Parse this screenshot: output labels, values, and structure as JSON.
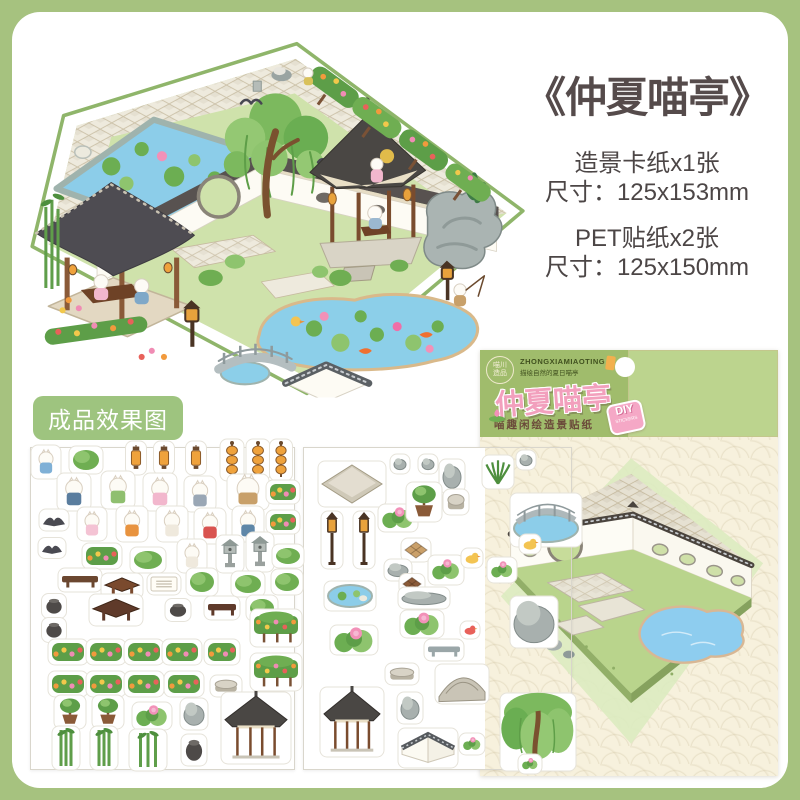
{
  "page": {
    "frame_color": "#a6c27f",
    "card_color": "#ffffff"
  },
  "product_info": {
    "title": "《仲夏喵亭》",
    "spec_lines": [
      "造景卡纸x1张",
      "尺寸：125x153mm",
      "PET贴纸x2张",
      "尺寸：125x150mm"
    ]
  },
  "effect_label": "成品效果图",
  "package": {
    "brand_stamp_line1": "喵川",
    "brand_stamp_line2": "造品",
    "brand_pinyin": "ZHONGXIAMIAOTING",
    "brand_tagline": "描绘自然的夏日喵亭",
    "title": "仲夏喵亭",
    "subtitle": "喵趣闲绘造景贴纸",
    "diy_badge": "DIY",
    "diy_badge_sub": "stickers",
    "header_color": "#a0bc6c",
    "body_color": "#f7f1dd",
    "title_pink": "#f2a0bd"
  },
  "colors": {
    "frame_green": "#a6c27f",
    "label_green": "#9ec47f",
    "text_dark": "#554b4b",
    "pond_blue": "#8ccde9",
    "grass_green": "#cfe2ab",
    "roof_dark": "#4e4c52",
    "stone_pale": "#eeeadd",
    "hedge_green": "#5d9e48",
    "lantern_orange": "#efa23c",
    "lotus_pink": "#f291b8",
    "wood_brown": "#7a4c2e"
  },
  "scene_icons": [
    "lotus-pond",
    "willow-tree",
    "hex-pavilion",
    "study-pavilion",
    "rockery",
    "koi-pond",
    "stone-bridge",
    "moon-gate",
    "flower-hedge",
    "cat-figures",
    "lamp-post",
    "bamboo"
  ],
  "sticker_sheets": {
    "sheet1_items": [
      [
        "cat",
        46,
        462,
        22,
        26,
        "#7fb0d6"
      ],
      [
        "bush",
        86,
        460,
        26,
        20
      ],
      [
        "lantern",
        136,
        458,
        13,
        26
      ],
      [
        "lantern",
        164,
        458,
        13,
        26
      ],
      [
        "lantern",
        196,
        458,
        13,
        26
      ],
      [
        "lanternstack",
        232,
        460,
        16,
        34
      ],
      [
        "lanternstack",
        258,
        460,
        16,
        34
      ],
      [
        "lanternstack",
        281,
        460,
        15,
        34
      ],
      [
        "cat",
        74,
        492,
        26,
        30,
        "#5a7d9e"
      ],
      [
        "cat",
        118,
        490,
        26,
        30,
        "#8fbf6f"
      ],
      [
        "cat",
        160,
        492,
        26,
        30,
        "#f2b7cd"
      ],
      [
        "cat",
        200,
        494,
        24,
        28,
        "#9aa7b5"
      ],
      [
        "cat",
        248,
        492,
        34,
        28,
        "#c8a06a"
      ],
      [
        "flowerbed",
        283,
        492,
        26,
        16
      ],
      [
        "bird",
        54,
        520,
        22,
        14
      ],
      [
        "bird",
        52,
        548,
        20,
        13
      ],
      [
        "cat",
        92,
        524,
        22,
        26,
        "#f4c3d4"
      ],
      [
        "cat",
        132,
        524,
        24,
        28,
        "#e8933f"
      ],
      [
        "cat",
        172,
        524,
        24,
        28,
        "#efe9dd"
      ],
      [
        "cat",
        210,
        526,
        24,
        28,
        "#d9534f"
      ],
      [
        "cat",
        248,
        524,
        24,
        28,
        "#5f87a8"
      ],
      [
        "flowerbed",
        283,
        522,
        26,
        16
      ],
      [
        "flowerbed",
        102,
        556,
        32,
        18
      ],
      [
        "bush",
        148,
        560,
        28,
        18
      ],
      [
        "cat",
        192,
        556,
        22,
        26,
        "#efe9dd"
      ],
      [
        "stonelantern",
        230,
        554,
        20,
        30
      ],
      [
        "stonelantern",
        260,
        552,
        20,
        32
      ],
      [
        "bush",
        288,
        556,
        24,
        16
      ],
      [
        "bench",
        80,
        580,
        36,
        16,
        "#6b4730"
      ],
      [
        "table",
        122,
        586,
        34,
        18,
        "#7a4a2e"
      ],
      [
        "paper",
        164,
        584,
        26,
        14
      ],
      [
        "bush",
        202,
        582,
        24,
        20
      ],
      [
        "bush",
        248,
        584,
        26,
        18
      ],
      [
        "bush",
        287,
        582,
        24,
        18
      ],
      [
        "jar",
        54,
        606,
        17,
        17
      ],
      [
        "table",
        116,
        610,
        46,
        24,
        "#5f3a2a"
      ],
      [
        "jar",
        178,
        610,
        18,
        15
      ],
      [
        "bench",
        222,
        608,
        28,
        16,
        "#5f3a2a"
      ],
      [
        "bush",
        262,
        608,
        24,
        18
      ],
      [
        "jar",
        54,
        630,
        17,
        17
      ],
      [
        "hedge",
        276,
        628,
        44,
        30
      ],
      [
        "flowerbed",
        68,
        652,
        32,
        18
      ],
      [
        "flowerbed",
        106,
        652,
        32,
        18
      ],
      [
        "flowerbed",
        144,
        652,
        32,
        18
      ],
      [
        "flowerbed",
        182,
        652,
        32,
        18
      ],
      [
        "flowerbed",
        222,
        652,
        28,
        18
      ],
      [
        "hedge",
        276,
        672,
        44,
        30
      ],
      [
        "flowerbed",
        68,
        684,
        32,
        18
      ],
      [
        "flowerbed",
        106,
        684,
        32,
        18
      ],
      [
        "flowerbed",
        144,
        684,
        32,
        18
      ],
      [
        "flowerbed",
        184,
        684,
        32,
        18
      ],
      [
        "stool",
        226,
        686,
        24,
        14
      ],
      [
        "bonsai",
        70,
        712,
        24,
        26
      ],
      [
        "bonsai",
        108,
        712,
        24,
        26
      ],
      [
        "lotus",
        152,
        716,
        32,
        20
      ],
      [
        "rock",
        194,
        714,
        20,
        24
      ],
      [
        "pavilion",
        256,
        728,
        62,
        64
      ],
      [
        "bamboo",
        66,
        748,
        20,
        36
      ],
      [
        "bamboo",
        104,
        748,
        20,
        36
      ],
      [
        "bamboo",
        148,
        750,
        30,
        34
      ],
      [
        "jar",
        194,
        750,
        18,
        24
      ]
    ],
    "sheet2_items": [
      [
        "platform",
        352,
        484,
        60,
        38
      ],
      [
        "rock",
        400,
        464,
        12,
        12
      ],
      [
        "rock",
        428,
        464,
        12,
        12
      ],
      [
        "rock",
        452,
        476,
        18,
        26
      ],
      [
        "lamppost",
        332,
        540,
        14,
        50
      ],
      [
        "lamppost",
        364,
        540,
        14,
        50
      ],
      [
        "lotus",
        398,
        518,
        32,
        20
      ],
      [
        "bonsai",
        424,
        502,
        28,
        32
      ],
      [
        "stool",
        456,
        502,
        18,
        18
      ],
      [
        "mat",
        416,
        550,
        22,
        16,
        "#caa06a"
      ],
      [
        "rock",
        398,
        570,
        20,
        14
      ],
      [
        "mat",
        412,
        584,
        18,
        13,
        "#8a5a38"
      ],
      [
        "lotus",
        446,
        570,
        28,
        22
      ],
      [
        "duck",
        472,
        558,
        14,
        12
      ],
      [
        "pond",
        350,
        596,
        44,
        22
      ],
      [
        "rock",
        424,
        598,
        44,
        14
      ],
      [
        "lotus",
        422,
        624,
        36,
        20
      ],
      [
        "lotus",
        354,
        640,
        40,
        22
      ],
      [
        "bench",
        444,
        650,
        32,
        14,
        "#9aa6a8"
      ],
      [
        "duck",
        470,
        630,
        12,
        10,
        "#e8615a"
      ],
      [
        "stool",
        402,
        674,
        26,
        14
      ],
      [
        "pavilion",
        352,
        722,
        56,
        62
      ],
      [
        "steps",
        462,
        684,
        46,
        32
      ],
      [
        "rock",
        410,
        708,
        18,
        24
      ],
      [
        "wallcorner",
        428,
        748,
        52,
        32
      ],
      [
        "lotus",
        472,
        744,
        18,
        14
      ],
      [
        "fern",
        498,
        472,
        24,
        26
      ],
      [
        "rock",
        526,
        460,
        12,
        12
      ],
      [
        "bridgepond",
        546,
        520,
        64,
        46
      ],
      [
        "duck",
        530,
        544,
        14,
        12
      ],
      [
        "lotus",
        502,
        570,
        22,
        18
      ],
      [
        "rock",
        534,
        622,
        40,
        44
      ],
      [
        "willow",
        538,
        732,
        68,
        70
      ],
      [
        "lotus",
        530,
        764,
        16,
        12
      ]
    ]
  }
}
